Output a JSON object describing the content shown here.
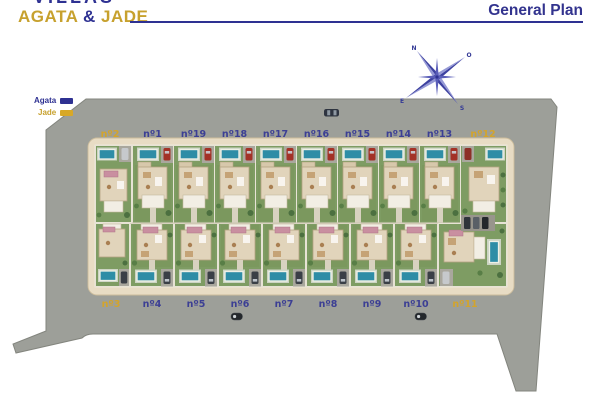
{
  "header": {
    "logo": {
      "line1": "VILLAS",
      "word1": "AGATA",
      "amp": "&",
      "word2": "JADE"
    },
    "page_title": "General Plan"
  },
  "legend": {
    "items": [
      {
        "label": "Agata",
        "color": "#2e3192"
      },
      {
        "label": "Jade",
        "color": "#d8a827"
      }
    ]
  },
  "compass": {
    "top_left": "N",
    "top_right": "O",
    "bottom_left": "E",
    "bottom_right": "S"
  },
  "plan": {
    "top_row": [
      {
        "label": "nº2",
        "type": "jade"
      },
      {
        "label": "nº1",
        "type": "agata"
      },
      {
        "label": "nº19",
        "type": "agata"
      },
      {
        "label": "nº18",
        "type": "agata"
      },
      {
        "label": "nº17",
        "type": "agata"
      },
      {
        "label": "nº16",
        "type": "agata"
      },
      {
        "label": "nº15",
        "type": "agata"
      },
      {
        "label": "nº14",
        "type": "agata"
      },
      {
        "label": "nº13",
        "type": "agata"
      },
      {
        "label": "nº12",
        "type": "jade"
      }
    ],
    "bottom_row": [
      {
        "label": "nº3",
        "type": "jade"
      },
      {
        "label": "nº4",
        "type": "agata"
      },
      {
        "label": "nº5",
        "type": "agata"
      },
      {
        "label": "nº6",
        "type": "agata"
      },
      {
        "label": "nº7",
        "type": "agata"
      },
      {
        "label": "nº8",
        "type": "agata"
      },
      {
        "label": "nº9",
        "type": "agata"
      },
      {
        "label": "nº10",
        "type": "agata"
      },
      {
        "label": "nº11",
        "type": "jade"
      }
    ],
    "colors": {
      "agata_label": "#3c3f94",
      "jade_label": "#d3a42c",
      "asphalt": "#9d9f99",
      "road_ring": "#e8dcc4",
      "lawn": "#7e9c63",
      "pool": "#2e8da6",
      "house": "#e1d4bb"
    }
  }
}
